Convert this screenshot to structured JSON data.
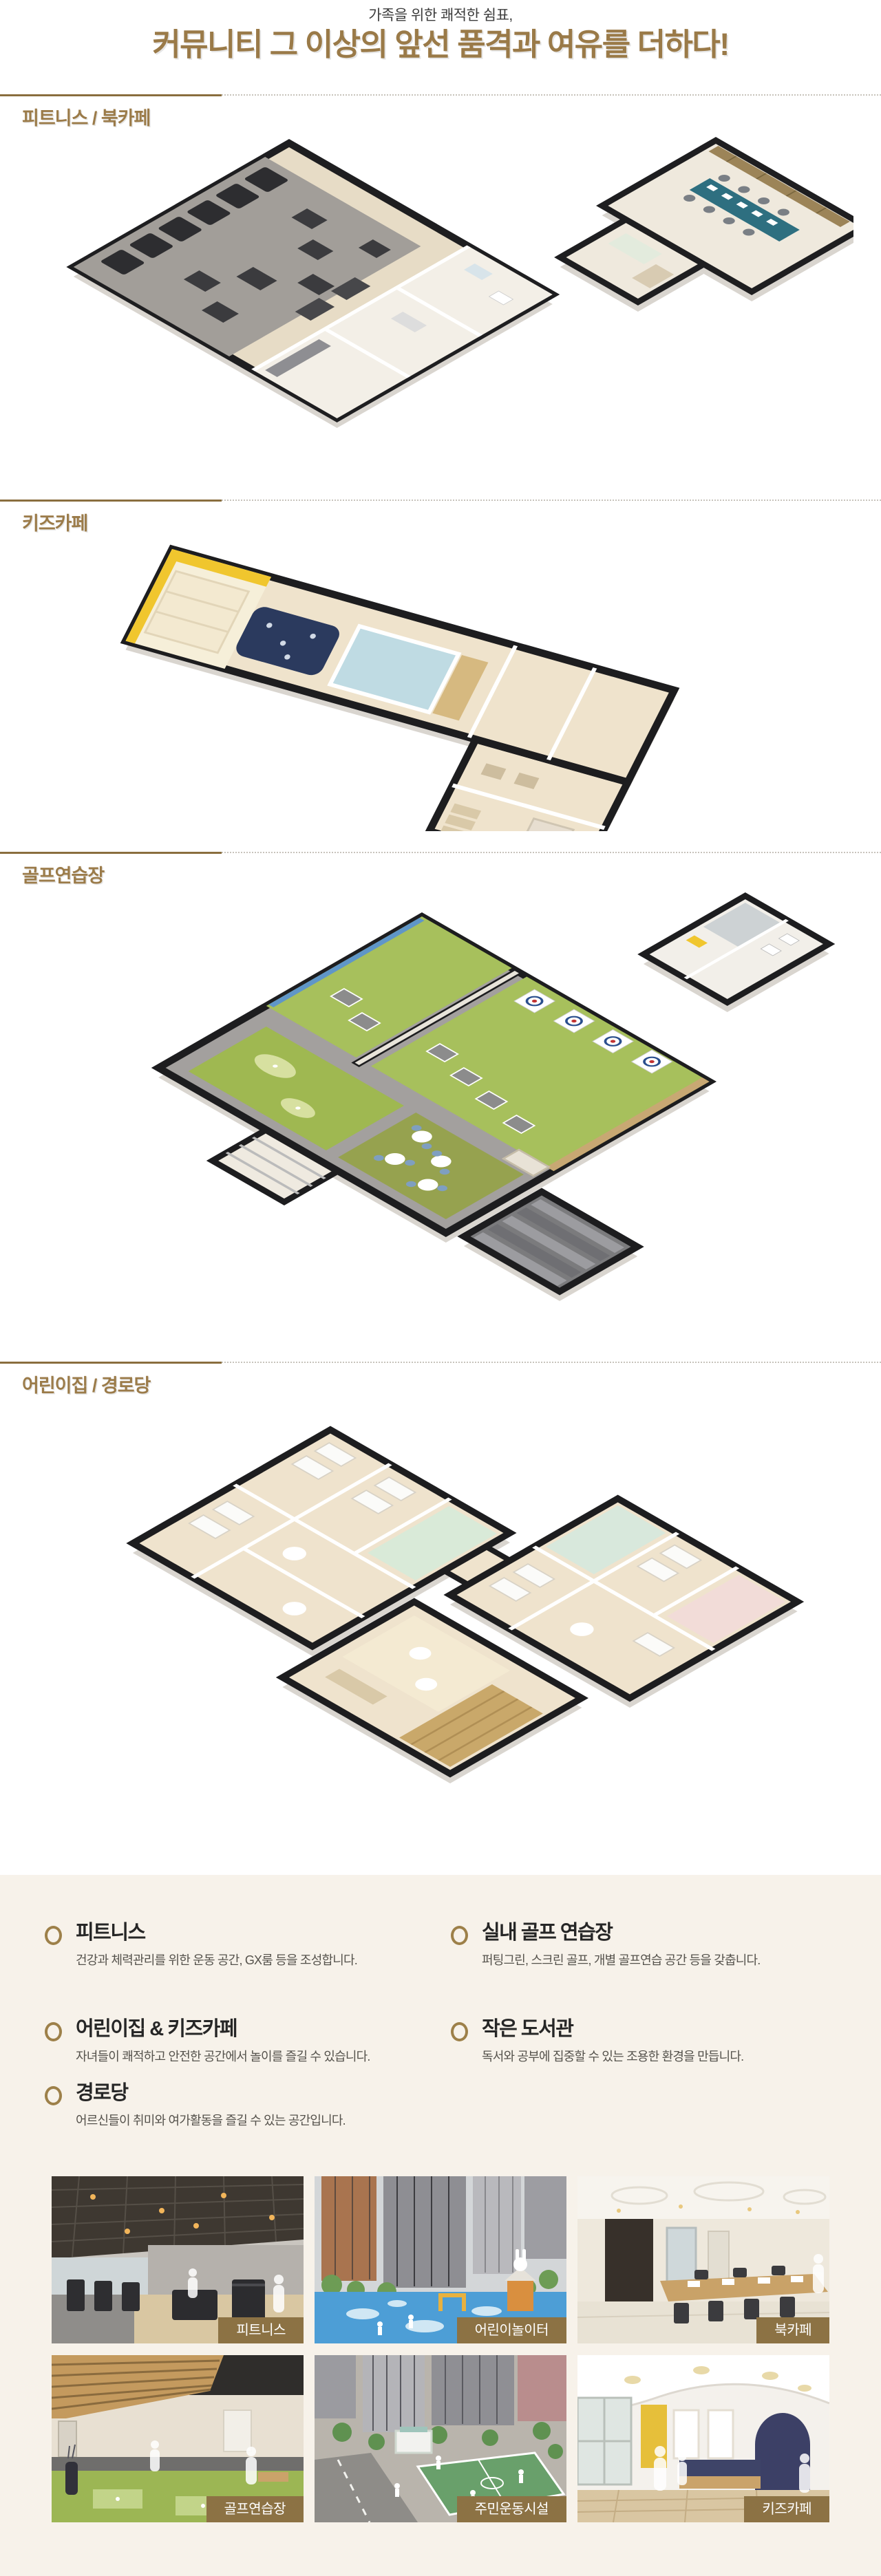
{
  "page": {
    "subtitle": "가족을 위한 쾌적한 쉼표,",
    "title": "커뮤니티 그 이상의 앞선 품격과 여유를 더하다!"
  },
  "colors": {
    "brand_brown": "#9a7a48",
    "divider_brown": "#8a6e3e",
    "badge_brown": "#8c7244",
    "info_background": "#f7f2ea",
    "bullet_ring": "#9d8049"
  },
  "icons": {
    "bullet": "ring-circle"
  },
  "sections": [
    {
      "label": "피트니스 / 북카페"
    },
    {
      "label": "키즈카페"
    },
    {
      "label": "골프연습장"
    },
    {
      "label": "어린이집 / 경로당"
    }
  ],
  "info": {
    "left": [
      {
        "title": "피트니스",
        "desc": "건강과 체력관리를 위한 운동 공간, GX룸 등을 조성합니다."
      },
      {
        "title": "어린이집 & 키즈카페",
        "desc": "자녀들이 쾌적하고 안전한 공간에서 놀이를 즐길 수 있습니다."
      },
      {
        "title": "경로당",
        "desc": "어르신들이 취미와 여가활동을 즐길 수 있는 공간입니다."
      }
    ],
    "right": [
      {
        "title": "실내 골프 연습장",
        "desc": "퍼팅그린, 스크린 골프, 개별 골프연습 공간 등을 갖춥니다."
      },
      {
        "title": "작은 도서관",
        "desc": "독서와 공부에 집중할 수 있는 조용한 환경을 만듭니다."
      }
    ]
  },
  "photos": [
    {
      "label": "피트니스"
    },
    {
      "label": "어린이놀이터"
    },
    {
      "label": "북카페"
    },
    {
      "label": "골프연습장"
    },
    {
      "label": "주민운동시설"
    },
    {
      "label": "키즈카페"
    }
  ]
}
